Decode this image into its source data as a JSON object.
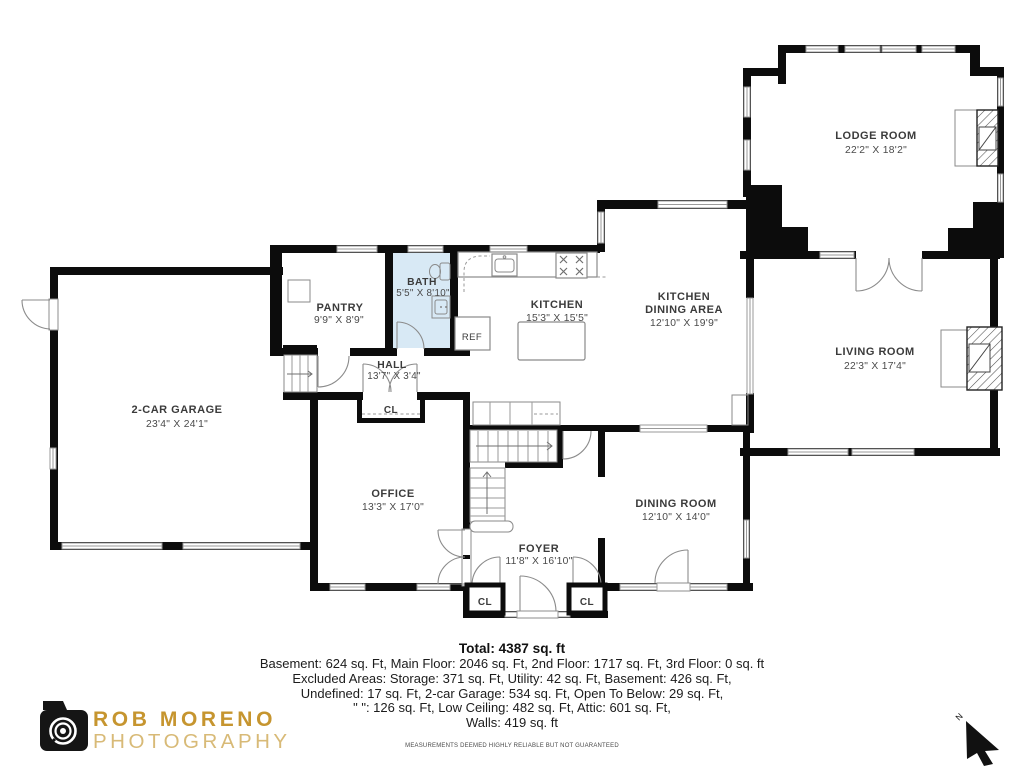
{
  "floor_plan": {
    "rooms": {
      "lodge": {
        "name": "LODGE ROOM",
        "dims": "22'2\" X 18'2\""
      },
      "living": {
        "name": "LIVING ROOM",
        "dims": "22'3\" X 17'4\""
      },
      "kitchen": {
        "name": "KITCHEN",
        "dims": "15'3\" X 15'5\""
      },
      "kitchen_dining": {
        "name_line1": "KITCHEN",
        "name_line2": "DINING AREA",
        "dims": "12'10\" X 19'9\""
      },
      "bath": {
        "name": "BATH",
        "dims": "5'5\" X 8'10\""
      },
      "pantry": {
        "name": "PANTRY",
        "dims": "9'9\" X 8'9\""
      },
      "hall": {
        "name": "HALL",
        "dims": "13'7\" X 3'4\""
      },
      "garage": {
        "name": "2-CAR GARAGE",
        "dims": "23'4\" X 24'1\""
      },
      "office": {
        "name": "OFFICE",
        "dims": "13'3\" X 17'0\""
      },
      "foyer": {
        "name": "FOYER",
        "dims": "11'8\" X 16'10\""
      },
      "dining": {
        "name": "DINING ROOM",
        "dims": "12'10\" X 14'0\""
      }
    },
    "labels": {
      "closet": "CL",
      "fridge": "REF"
    },
    "compass_n": "N"
  },
  "summary": {
    "total": "Total: 4387 sq. ft",
    "lines": [
      "Basement: 624 sq. Ft, Main Floor: 2046 sq. Ft, 2nd Floor: 1717 sq. Ft, 3rd Floor: 0 sq. ft",
      "Excluded Areas: Storage: 371 sq. Ft, Utility: 42 sq. Ft, Basement: 426 sq. Ft,",
      "Undefined: 17 sq. Ft, 2-car Garage: 534 sq. Ft, Open To Below: 29 sq. Ft,",
      "\" \": 126 sq. Ft, Low Ceiling: 482 sq. Ft, Attic: 601 sq. Ft,",
      "Walls: 419 sq. ft"
    ],
    "disclaimer": "MEASUREMENTS DEEMED HIGHLY RELIABLE BUT NOT GUARANTEED"
  },
  "logo": {
    "name": "ROB MORENO",
    "subtitle": "PHOTOGRAPHY"
  },
  "colors": {
    "wall": "#0c0c0c",
    "bath_fill": "#d8e9f5",
    "brand_gold": "#c6952f",
    "brand_gold_light": "#d8ba77"
  }
}
